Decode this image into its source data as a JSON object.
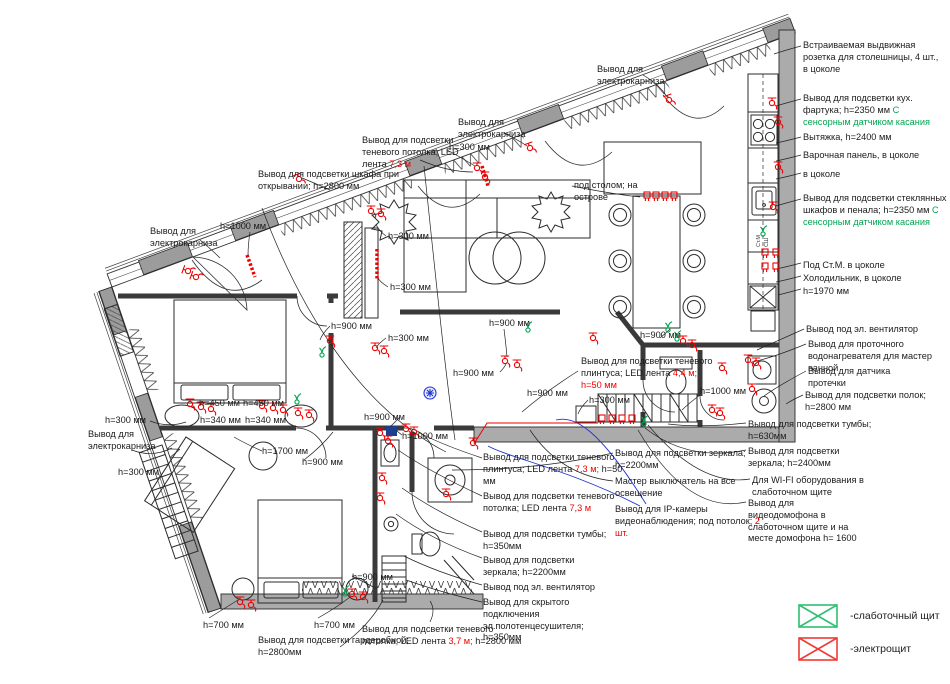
{
  "colors": {
    "red": "#f00000",
    "green": "#00a651",
    "blue": "#2233cc",
    "wall": "#ababab",
    "legend_green": "#2fbf71",
    "legend_red": "#ef3b36"
  },
  "plan": {
    "cabinet_labels": [
      "Ст.М",
      "СШ"
    ]
  },
  "legend": [
    {
      "icon": "low-current-panel",
      "color": "#2fbf71",
      "label": "-слаботочный щит"
    },
    {
      "icon": "electric-panel",
      "color": "#ef3b36",
      "label": "-электрощит"
    }
  ],
  "annotations": [
    {
      "x": 803,
      "y": 40,
      "w": 142,
      "segs": [
        {
          "t": "Встраиваемая выдвижная розетка для столешницы, 4 шт., в цоколе"
        }
      ]
    },
    {
      "x": 803,
      "y": 93,
      "w": 145,
      "segs": [
        {
          "t": "Вывод для подсветки кух. фартука; h=2350 мм "
        },
        {
          "t": "С сенсорным датчиком касания",
          "c": "green"
        }
      ]
    },
    {
      "x": 803,
      "y": 132,
      "w": 142,
      "segs": [
        {
          "t": "Вытяжка, h=2400 мм"
        }
      ]
    },
    {
      "x": 803,
      "y": 150,
      "w": 142,
      "segs": [
        {
          "t": "Варочная панель, в цоколе"
        }
      ]
    },
    {
      "x": 803,
      "y": 169,
      "w": 142,
      "segs": [
        {
          "t": "в цоколе"
        }
      ]
    },
    {
      "x": 803,
      "y": 193,
      "w": 148,
      "segs": [
        {
          "t": "Вывод для подсветки стеклянных шкафов и пенала; h=2350 мм "
        },
        {
          "t": "С сенсорным датчиком касания",
          "c": "green"
        }
      ]
    },
    {
      "x": 803,
      "y": 260,
      "w": 142,
      "segs": [
        {
          "t": "Под Ст.М. в цоколе"
        }
      ]
    },
    {
      "x": 803,
      "y": 273,
      "w": 142,
      "segs": [
        {
          "t": "Холодильник, в цоколе"
        }
      ]
    },
    {
      "x": 803,
      "y": 286,
      "w": 142,
      "segs": [
        {
          "t": "h=1970 мм"
        }
      ]
    },
    {
      "x": 806,
      "y": 324,
      "w": 142,
      "segs": [
        {
          "t": "Вывод под эл. вентилятор"
        }
      ]
    },
    {
      "x": 808,
      "y": 339,
      "w": 140,
      "segs": [
        {
          "t": "Вывод для проточного водонагревателя для мастер ванной"
        }
      ]
    },
    {
      "x": 808,
      "y": 366,
      "w": 100,
      "segs": [
        {
          "t": "Вывод для датчика протечки"
        }
      ]
    },
    {
      "x": 805,
      "y": 390,
      "w": 140,
      "segs": [
        {
          "t": "Вывод для подсветки полок; h=2800 мм"
        }
      ]
    },
    {
      "x": 748,
      "y": 419,
      "w": 125,
      "segs": [
        {
          "t": "Вывод для подсветки тумбы; h=630мм"
        }
      ]
    },
    {
      "x": 748,
      "y": 446,
      "w": 125,
      "segs": [
        {
          "t": "Вывод для подсветки зеркала; h=2400мм"
        }
      ]
    },
    {
      "x": 752,
      "y": 475,
      "w": 125,
      "segs": [
        {
          "t": "Для WI-FI оборудования в слаботочном щите"
        }
      ]
    },
    {
      "x": 748,
      "y": 498,
      "w": 112,
      "segs": [
        {
          "t": "Вывод для видеодомофона в слаботочном щите и на месте домофона h= 1600"
        }
      ]
    },
    {
      "x": 597,
      "y": 64,
      "w": 92,
      "segs": [
        {
          "t": "Вывод для электрокарниза"
        }
      ]
    },
    {
      "x": 458,
      "y": 117,
      "w": 92,
      "segs": [
        {
          "t": "Вывод для электрокарниза"
        }
      ]
    },
    {
      "x": 449,
      "y": 142,
      "w": 60,
      "segs": [
        {
          "t": "h=300 мм"
        }
      ]
    },
    {
      "x": 362,
      "y": 135,
      "w": 122,
      "segs": [
        {
          "t": "Вывод для подсветки теневого потолка; LED лента "
        },
        {
          "t": "7,3 м",
          "c": "red"
        }
      ]
    },
    {
      "x": 258,
      "y": 169,
      "w": 152,
      "segs": [
        {
          "t": "Вывод для подсветки шкафа при открывании; h=2800 мм"
        }
      ]
    },
    {
      "x": 220,
      "y": 221,
      "w": 70,
      "segs": [
        {
          "t": "h=1000 мм"
        }
      ]
    },
    {
      "x": 150,
      "y": 226,
      "w": 95,
      "segs": [
        {
          "t": "Вывод для электрокарниза"
        }
      ]
    },
    {
      "x": 574,
      "y": 180,
      "w": 80,
      "segs": [
        {
          "t": "под столом; на острове"
        }
      ]
    },
    {
      "x": 388,
      "y": 231,
      "w": 60,
      "segs": [
        {
          "t": "h=300 мм"
        }
      ]
    },
    {
      "x": 390,
      "y": 282,
      "w": 60,
      "segs": [
        {
          "t": "h=300 мм"
        }
      ]
    },
    {
      "x": 388,
      "y": 333,
      "w": 60,
      "segs": [
        {
          "t": "h=300 мм"
        }
      ]
    },
    {
      "x": 331,
      "y": 321,
      "w": 60,
      "segs": [
        {
          "t": "h=900 мм"
        }
      ]
    },
    {
      "x": 489,
      "y": 318,
      "w": 60,
      "segs": [
        {
          "t": "h=900 мм"
        }
      ]
    },
    {
      "x": 640,
      "y": 330,
      "w": 60,
      "segs": [
        {
          "t": "h=900 мм"
        }
      ]
    },
    {
      "x": 453,
      "y": 368,
      "w": 60,
      "segs": [
        {
          "t": "h=900 мм"
        }
      ]
    },
    {
      "x": 527,
      "y": 388,
      "w": 60,
      "segs": [
        {
          "t": "h=900 мм"
        }
      ]
    },
    {
      "x": 364,
      "y": 412,
      "w": 60,
      "segs": [
        {
          "t": "h=900 мм"
        }
      ]
    },
    {
      "x": 402,
      "y": 431,
      "w": 70,
      "segs": [
        {
          "t": "h=1000 мм"
        }
      ]
    },
    {
      "x": 589,
      "y": 395,
      "w": 60,
      "segs": [
        {
          "t": "h=300 мм"
        }
      ]
    },
    {
      "x": 700,
      "y": 386,
      "w": 70,
      "segs": [
        {
          "t": "h=1000 мм"
        }
      ]
    },
    {
      "x": 581,
      "y": 356,
      "w": 138,
      "segs": [
        {
          "t": "Вывод для подсветки теневого плинтуса; LED лента "
        },
        {
          "t": "4,4 м; ",
          "c": "red"
        },
        {
          "t": "h=50 мм",
          "c": "red"
        }
      ]
    },
    {
      "x": 199,
      "y": 398,
      "w": 56,
      "segs": [
        {
          "t": "h=450 мм"
        }
      ]
    },
    {
      "x": 243,
      "y": 398,
      "w": 56,
      "segs": [
        {
          "t": "h=450 мм"
        }
      ]
    },
    {
      "x": 200,
      "y": 415,
      "w": 56,
      "segs": [
        {
          "t": "h=340 мм"
        }
      ]
    },
    {
      "x": 245,
      "y": 415,
      "w": 56,
      "segs": [
        {
          "t": "h=340 мм"
        }
      ]
    },
    {
      "x": 262,
      "y": 446,
      "w": 64,
      "segs": [
        {
          "t": "h=1700 мм"
        }
      ]
    },
    {
      "x": 302,
      "y": 457,
      "w": 60,
      "segs": [
        {
          "t": "h=900 мм"
        }
      ]
    },
    {
      "x": 105,
      "y": 415,
      "w": 60,
      "segs": [
        {
          "t": "h=300 мм"
        }
      ]
    },
    {
      "x": 88,
      "y": 429,
      "w": 88,
      "segs": [
        {
          "t": "Вывод для электрокарниза"
        }
      ]
    },
    {
      "x": 118,
      "y": 467,
      "w": 60,
      "segs": [
        {
          "t": "h=300 мм"
        }
      ]
    },
    {
      "x": 203,
      "y": 620,
      "w": 60,
      "segs": [
        {
          "t": "h=700 мм"
        }
      ]
    },
    {
      "x": 314,
      "y": 620,
      "w": 60,
      "segs": [
        {
          "t": "h=700 мм"
        }
      ]
    },
    {
      "x": 258,
      "y": 635,
      "w": 165,
      "segs": [
        {
          "t": "Вывод для подсветки гардеробной; h=2800мм"
        }
      ]
    },
    {
      "x": 362,
      "y": 624,
      "w": 168,
      "segs": [
        {
          "t": "Вывод для подсветки теневого потолка; LED лента "
        },
        {
          "t": "3,7 м;",
          "c": "red"
        },
        {
          "t": " h=2800 мм"
        }
      ]
    },
    {
      "x": 352,
      "y": 572,
      "w": 58,
      "segs": [
        {
          "t": "h=900 мм"
        }
      ]
    },
    {
      "x": 483,
      "y": 452,
      "w": 142,
      "segs": [
        {
          "t": "Вывод для подсветки теневого плинтуса; LED лента "
        },
        {
          "t": "7,3 м;",
          "c": "red"
        },
        {
          "t": " h=50 мм"
        }
      ]
    },
    {
      "x": 483,
      "y": 491,
      "w": 142,
      "segs": [
        {
          "t": "Вывод для подсветки теневого потолка; LED лента "
        },
        {
          "t": "7,3 м",
          "c": "red"
        }
      ]
    },
    {
      "x": 483,
      "y": 529,
      "w": 130,
      "segs": [
        {
          "t": "Вывод для подсветки тумбы; h=350мм"
        }
      ]
    },
    {
      "x": 483,
      "y": 555,
      "w": 130,
      "segs": [
        {
          "t": "Вывод для подсветки зеркала; h=2200мм"
        }
      ]
    },
    {
      "x": 483,
      "y": 582,
      "w": 142,
      "segs": [
        {
          "t": "Вывод под эл. вентилятор"
        }
      ]
    },
    {
      "x": 483,
      "y": 597,
      "w": 135,
      "segs": [
        {
          "t": "Вывод для скрытого подключения эл.полотенцесушителя; h=350мм"
        }
      ]
    },
    {
      "x": 615,
      "y": 448,
      "w": 138,
      "segs": [
        {
          "t": "Вывод для подсветки зеркала; h=2200мм"
        }
      ]
    },
    {
      "x": 615,
      "y": 476,
      "w": 142,
      "segs": [
        {
          "t": "Мастер выключатель на все освещение"
        }
      ]
    },
    {
      "x": 615,
      "y": 504,
      "w": 145,
      "segs": [
        {
          "t": "Вывод для IP-камеры видеонаблюдения; под потолок; "
        },
        {
          "t": "2 шт.",
          "c": "red"
        }
      ]
    }
  ]
}
